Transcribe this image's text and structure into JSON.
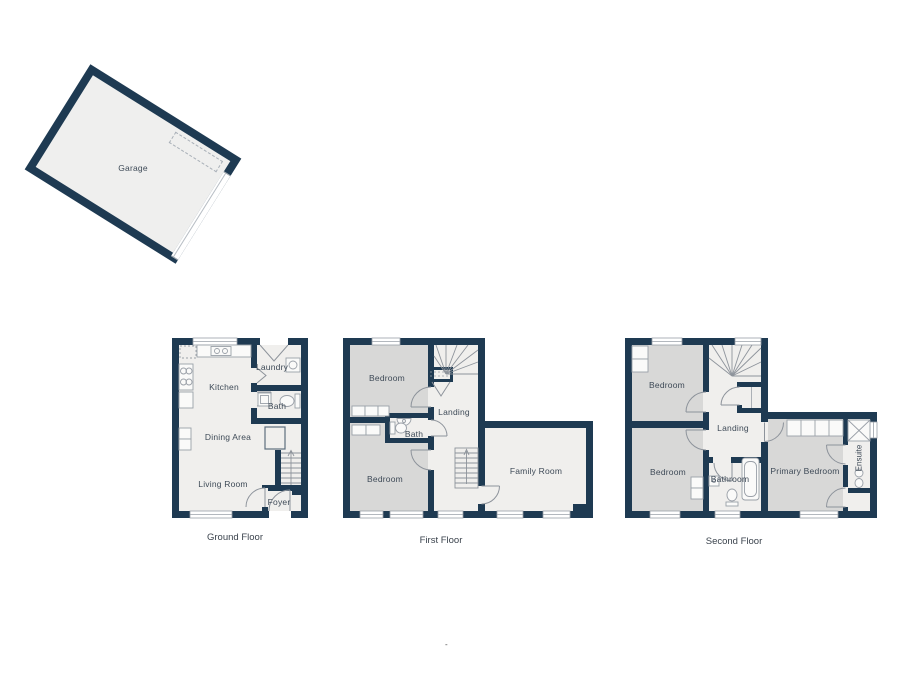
{
  "colors": {
    "wall": "#1e3a52",
    "room_light": "#f0efed",
    "room_gray": "#d8d8d7",
    "fixture_line": "#8d939b",
    "label_text": "#3e4a57"
  },
  "garage": {
    "label": "Garage"
  },
  "ground_floor": {
    "title": "Ground Floor",
    "rooms": {
      "kitchen": "Kitchen",
      "laundry": "Laundry",
      "bath": "Bath",
      "dining": "Dining Area",
      "living": "Living Room",
      "foyer": "Foyer"
    }
  },
  "first_floor": {
    "title": "First Floor",
    "rooms": {
      "bedroom_a": "Bedroom",
      "bedroom_b": "Bedroom",
      "bath": "Bath",
      "landing": "Landing",
      "family": "Family Room"
    }
  },
  "second_floor": {
    "title": "Second Floor",
    "rooms": {
      "bedroom_a": "Bedroom",
      "bedroom_b": "Bedroom",
      "landing": "Landing",
      "bathroom": "Bathroom",
      "primary": "Primary Bedroom",
      "ensuite": "Ensuite"
    }
  },
  "footer": {
    "mark": "-"
  }
}
